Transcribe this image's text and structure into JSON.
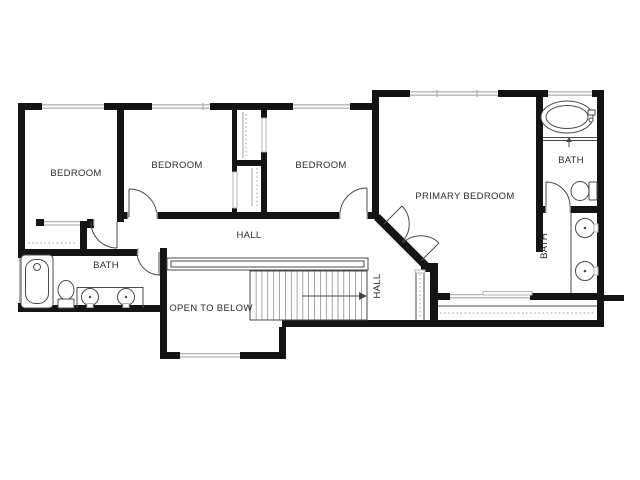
{
  "palette": {
    "wall": "#141414",
    "fixture_line": "#4a4a4a",
    "glazing": "#b5b5b5",
    "dashed_line": "#999999",
    "label_text": "#2b2b2b",
    "background": "#ffffff"
  },
  "rooms": {
    "bedroom_1": {
      "label": "BEDROOM"
    },
    "bedroom_2": {
      "label": "BEDROOM"
    },
    "bedroom_3": {
      "label": "BEDROOM"
    },
    "primary_bedroom": {
      "label": "PRIMARY BEDROOM"
    },
    "primary_bath_wc": {
      "label": "BATH"
    },
    "primary_bath_vanity": {
      "label": "BATH"
    },
    "hall_bath": {
      "label": "BATH"
    },
    "hall": {
      "label": "HALL"
    },
    "stair_hall": {
      "label": "HALL"
    },
    "open_to_below": {
      "label": "OPEN TO BELOW"
    }
  },
  "icons": {
    "oval-tub-icon": "double ellipse with faucet block",
    "alcove-tub-icon": "rounded rectangle tub with drain circle",
    "toilet-icon": "tank rectangle with bowl ellipse",
    "sink-icon": "circle basin with center dot and faucet tick",
    "shower-arrow-icon": "small up arrow",
    "stair-arrow-icon": "thin line with right arrowhead",
    "door-swing-icon": "quarter-circle arc with leaf line",
    "window-icon": "parallel double lines in wall gap",
    "closet-rod-icon": "dashed line",
    "railing-icon": "thin double rail with dashed centerline"
  }
}
